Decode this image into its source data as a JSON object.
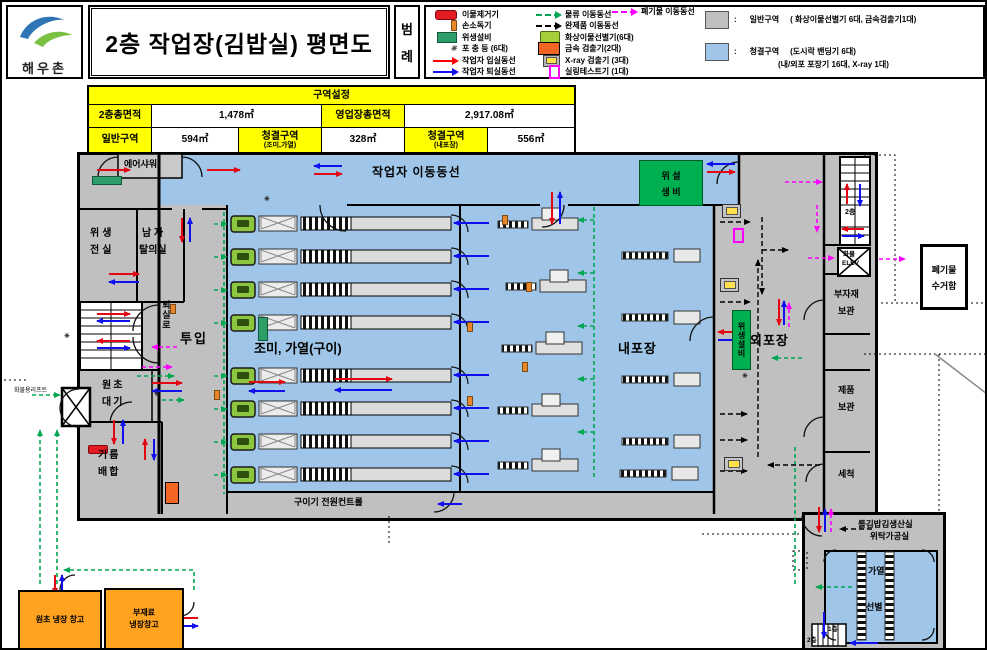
{
  "header": {
    "logo_text": "해우촌",
    "title": "2층 작업장(김밥실) 평면도",
    "legend_label": [
      "범",
      "례"
    ],
    "colon": ":"
  },
  "legend": {
    "col1": [
      {
        "icon": "foreign-matter-remover-icon",
        "label": "이물제거기"
      },
      {
        "icon": "hand-sanitizer-icon",
        "label": "손소독기"
      },
      {
        "icon": "sanitation-equipment-icon",
        "label": "위생설비"
      },
      {
        "icon": "insect-trap-icon",
        "label": "포 충 등 (6대)"
      },
      {
        "icon": "red-arrow-icon",
        "label": "작업자 입실동선"
      },
      {
        "icon": "blue-arrow-icon",
        "label": "작업자 퇴실동선"
      }
    ],
    "col2": [
      {
        "icon": "green-dashed-arrow-icon",
        "label": "물류 이동동선"
      },
      {
        "icon": "black-dashed-arrow-icon",
        "label": "완제품 이동동선"
      },
      {
        "icon": "vision-sorter-icon",
        "label": "화상이물선별기(6대)"
      },
      {
        "icon": "metal-detector-icon",
        "label": "금속 검출기(2대)"
      },
      {
        "icon": "xray-detector-icon",
        "label": "X-ray 검출기 (3대)"
      },
      {
        "icon": "seal-tester-icon",
        "label": "실링테스트기 (1대)"
      }
    ],
    "col3": [
      {
        "icon": "magenta-dashed-arrow-icon",
        "label": "폐기물 이동동선"
      }
    ],
    "zones": [
      {
        "swatch": "#bfbfbf",
        "label": "일반구역",
        "desc": "( 화상이물선별기 6대,  금속검출기1대)"
      },
      {
        "swatch": "#9fc5e8",
        "label": "청결구역",
        "desc": "(도시락 밴딩기 6대)",
        "desc2": "(내/외포 포장기 16대, X-ray 1대)"
      }
    ]
  },
  "area_table": {
    "title": "구역설정",
    "row1": [
      {
        "label": "2층총면적",
        "value": "1,478㎡"
      },
      {
        "label": "영업장총면적",
        "value": "2,917.08㎡"
      }
    ],
    "row2": [
      {
        "label": "일반구역",
        "value": "594㎡"
      },
      {
        "label": "청결구역",
        "sub": "(조미,가열)",
        "value": "328㎡"
      },
      {
        "label": "청결구역",
        "sub": "(내포장)",
        "value": "556㎡"
      }
    ]
  },
  "plan": {
    "worker_route": "작업자 이동동선",
    "air_shower": "에어샤워",
    "sanitary_anteroom": [
      "위생",
      "전실"
    ],
    "mens_changing": [
      "남 자",
      "탈의실"
    ],
    "exit_corridor": "퇴실로",
    "input": "투입",
    "raw_waiting": [
      "원초",
      "대기"
    ],
    "oil_mixing": [
      "기름",
      "배합"
    ],
    "seasoning_heating": "조미, 가열(구이)",
    "inner_packing": "내포장",
    "outer_packing": "외포장",
    "sanitary_equipment_top": [
      "위 설",
      "생 비"
    ],
    "sanitary_equipment_bar": "위생설비",
    "roaster_control": "구이기 전원컨트롤",
    "cargo_lift": "화물용리프트",
    "cargo_elevator": [
      "화물",
      "ELEV"
    ],
    "submaterial_storage": [
      "부자재",
      "보관"
    ],
    "product_storage": [
      "제품",
      "보관"
    ],
    "washing": "세척",
    "waste_box": [
      "폐기물",
      "수거함"
    ],
    "floor_2": "2층",
    "floor_1": "1층",
    "floor_2b": "2층",
    "annex_title": [
      "롤김밥김생산실",
      "위탁가공실"
    ],
    "annex_heating": "가열",
    "annex_sorting": "선별",
    "raw_cold_storage": "원초 냉장 창고",
    "submaterial_cold_storage": [
      "부재료",
      "냉장창고"
    ]
  }
}
